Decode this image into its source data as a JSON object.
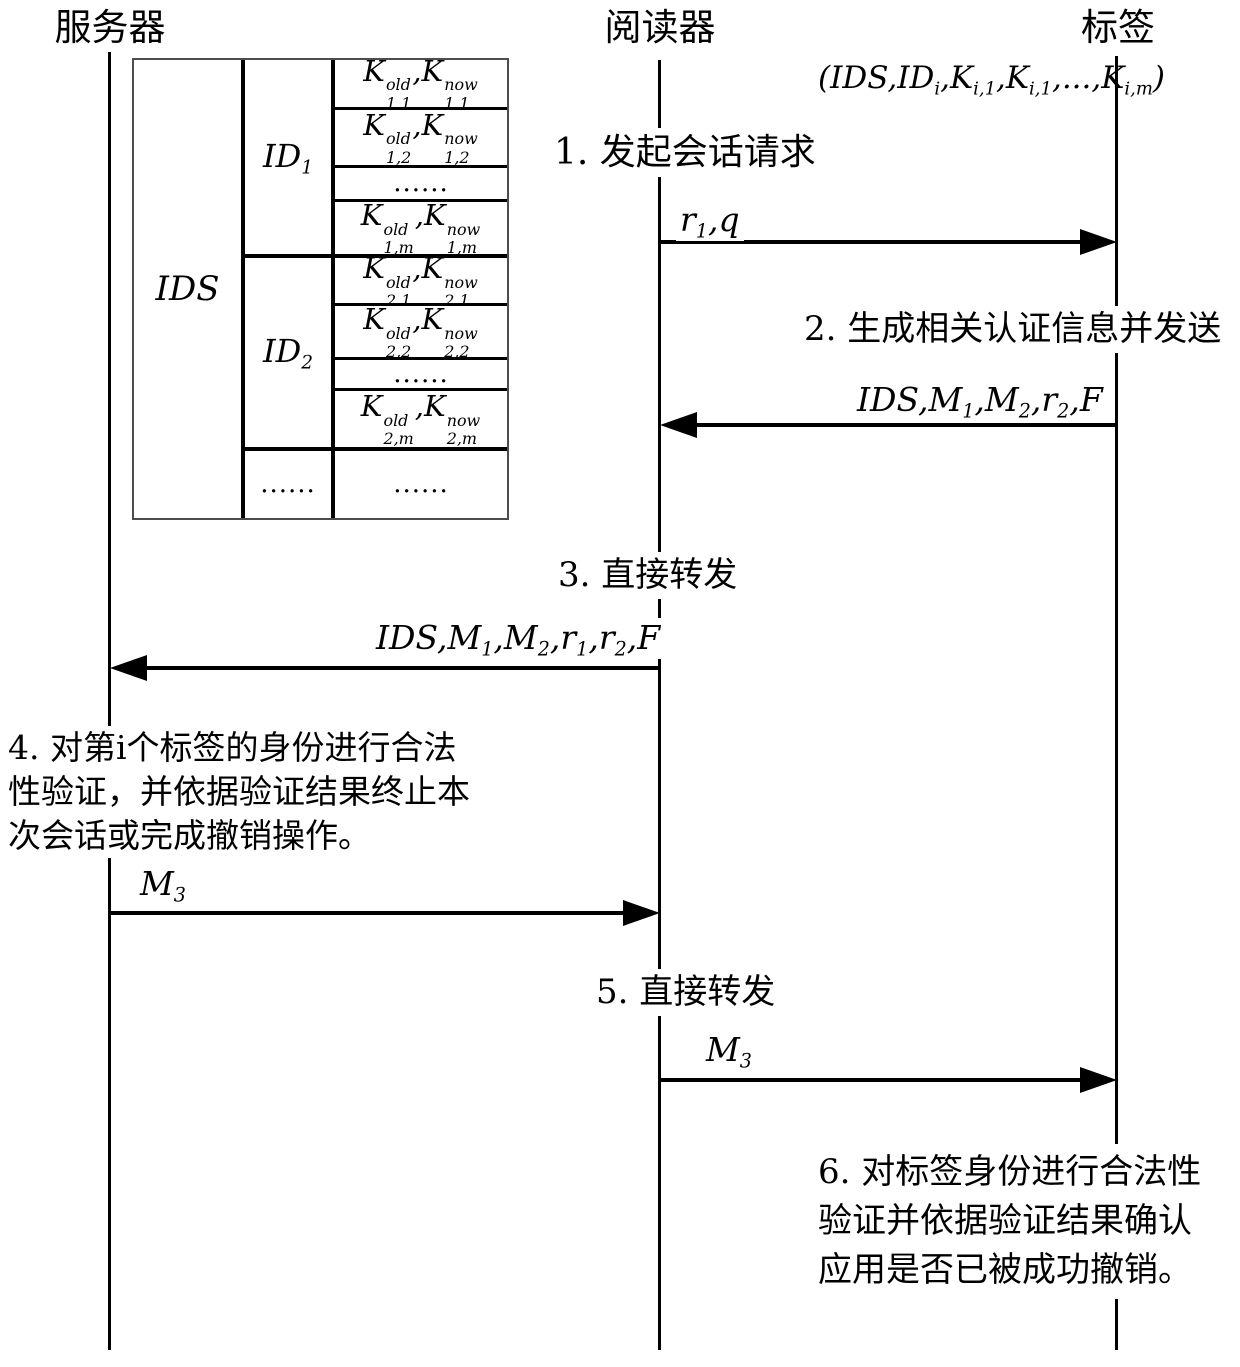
{
  "diagram": {
    "actors": {
      "server": "服务器",
      "reader": "阅读器",
      "tag": "标签"
    },
    "tag_tuple": "(IDS,ID_{i},K_{i,1},K_{i,1},...,K_{i,m})",
    "table": {
      "ids_label": "IDS",
      "id1_label": "ID_{1}",
      "id2_label": "ID_{2}",
      "id_more": "......",
      "keys": [
        "K^{old}_{1,1},K^{now}_{1,1}",
        "K^{old}_{1,2},K^{now}_{1,2}",
        "......",
        "K^{old}_{1,m},K^{now}_{1,m}",
        "K^{old}_{2,1},K^{now}_{2,1}",
        "K^{old}_{2,2},K^{now}_{2,2}",
        "......",
        "K^{old}_{2,m},K^{now}_{2,m}",
        "......"
      ]
    },
    "steps": {
      "s1": "1. 发起会话请求",
      "s2": "2. 生成相关认证信息并发送",
      "s3": "3. 直接转发",
      "s5": "5. 直接转发"
    },
    "payloads": {
      "p1": "r_{1},q",
      "p2": "IDS,M_{1},M_{2},r_{2},F",
      "p3": "IDS,M_{1},M_{2},r_{1},r_{2},F",
      "p4": "M_{3}",
      "p5": "M_{3}"
    },
    "notes": {
      "n4": {
        "lines": [
          "4. 对第i个标签的身份进行合法",
          "性验证，并依据验证结果终止本",
          "次会话或完成撤销操作。"
        ]
      },
      "n6": {
        "lines": [
          "6. 对标签身份进行合法性",
          "验证并依据验证结果确认",
          "应用是否已被成功撤销。"
        ]
      }
    },
    "colors": {
      "ink": "#000000",
      "background": "#ffffff",
      "table_outer_border": "#4d4d4d"
    }
  }
}
